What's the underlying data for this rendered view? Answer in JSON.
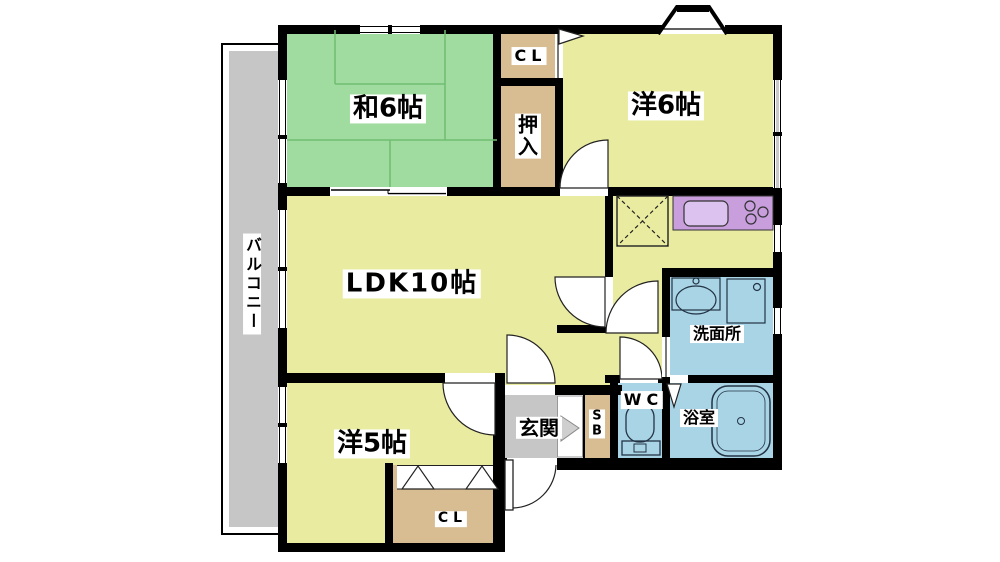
{
  "colors": {
    "wall": "#000000",
    "yellow": "#e8eba0",
    "green": "#a0dca0",
    "greenline": "#70bd70",
    "tan": "#d8bc92",
    "blue": "#a9d4e5",
    "purple": "#c89edd",
    "purplelight": "#dcc2ee",
    "gray": "#c6c6c6",
    "labelbg": "#ffffff",
    "fixture": "#223344"
  },
  "labels": {
    "washitsu": "和6帖",
    "cl_top": "CL",
    "oshiire_1": "押",
    "oshiire_2": "入",
    "yoshitsu6": "洋6帖",
    "ldk": "LDK10帖",
    "balcony": "バルコニー",
    "senmenjo": "洗面所",
    "wc": "WC",
    "yokushitsu": "浴室",
    "sb_1": "S",
    "sb_2": "B",
    "genkan": "玄関",
    "yoshitsu5": "洋5帖",
    "cl_bottom": "CL"
  }
}
